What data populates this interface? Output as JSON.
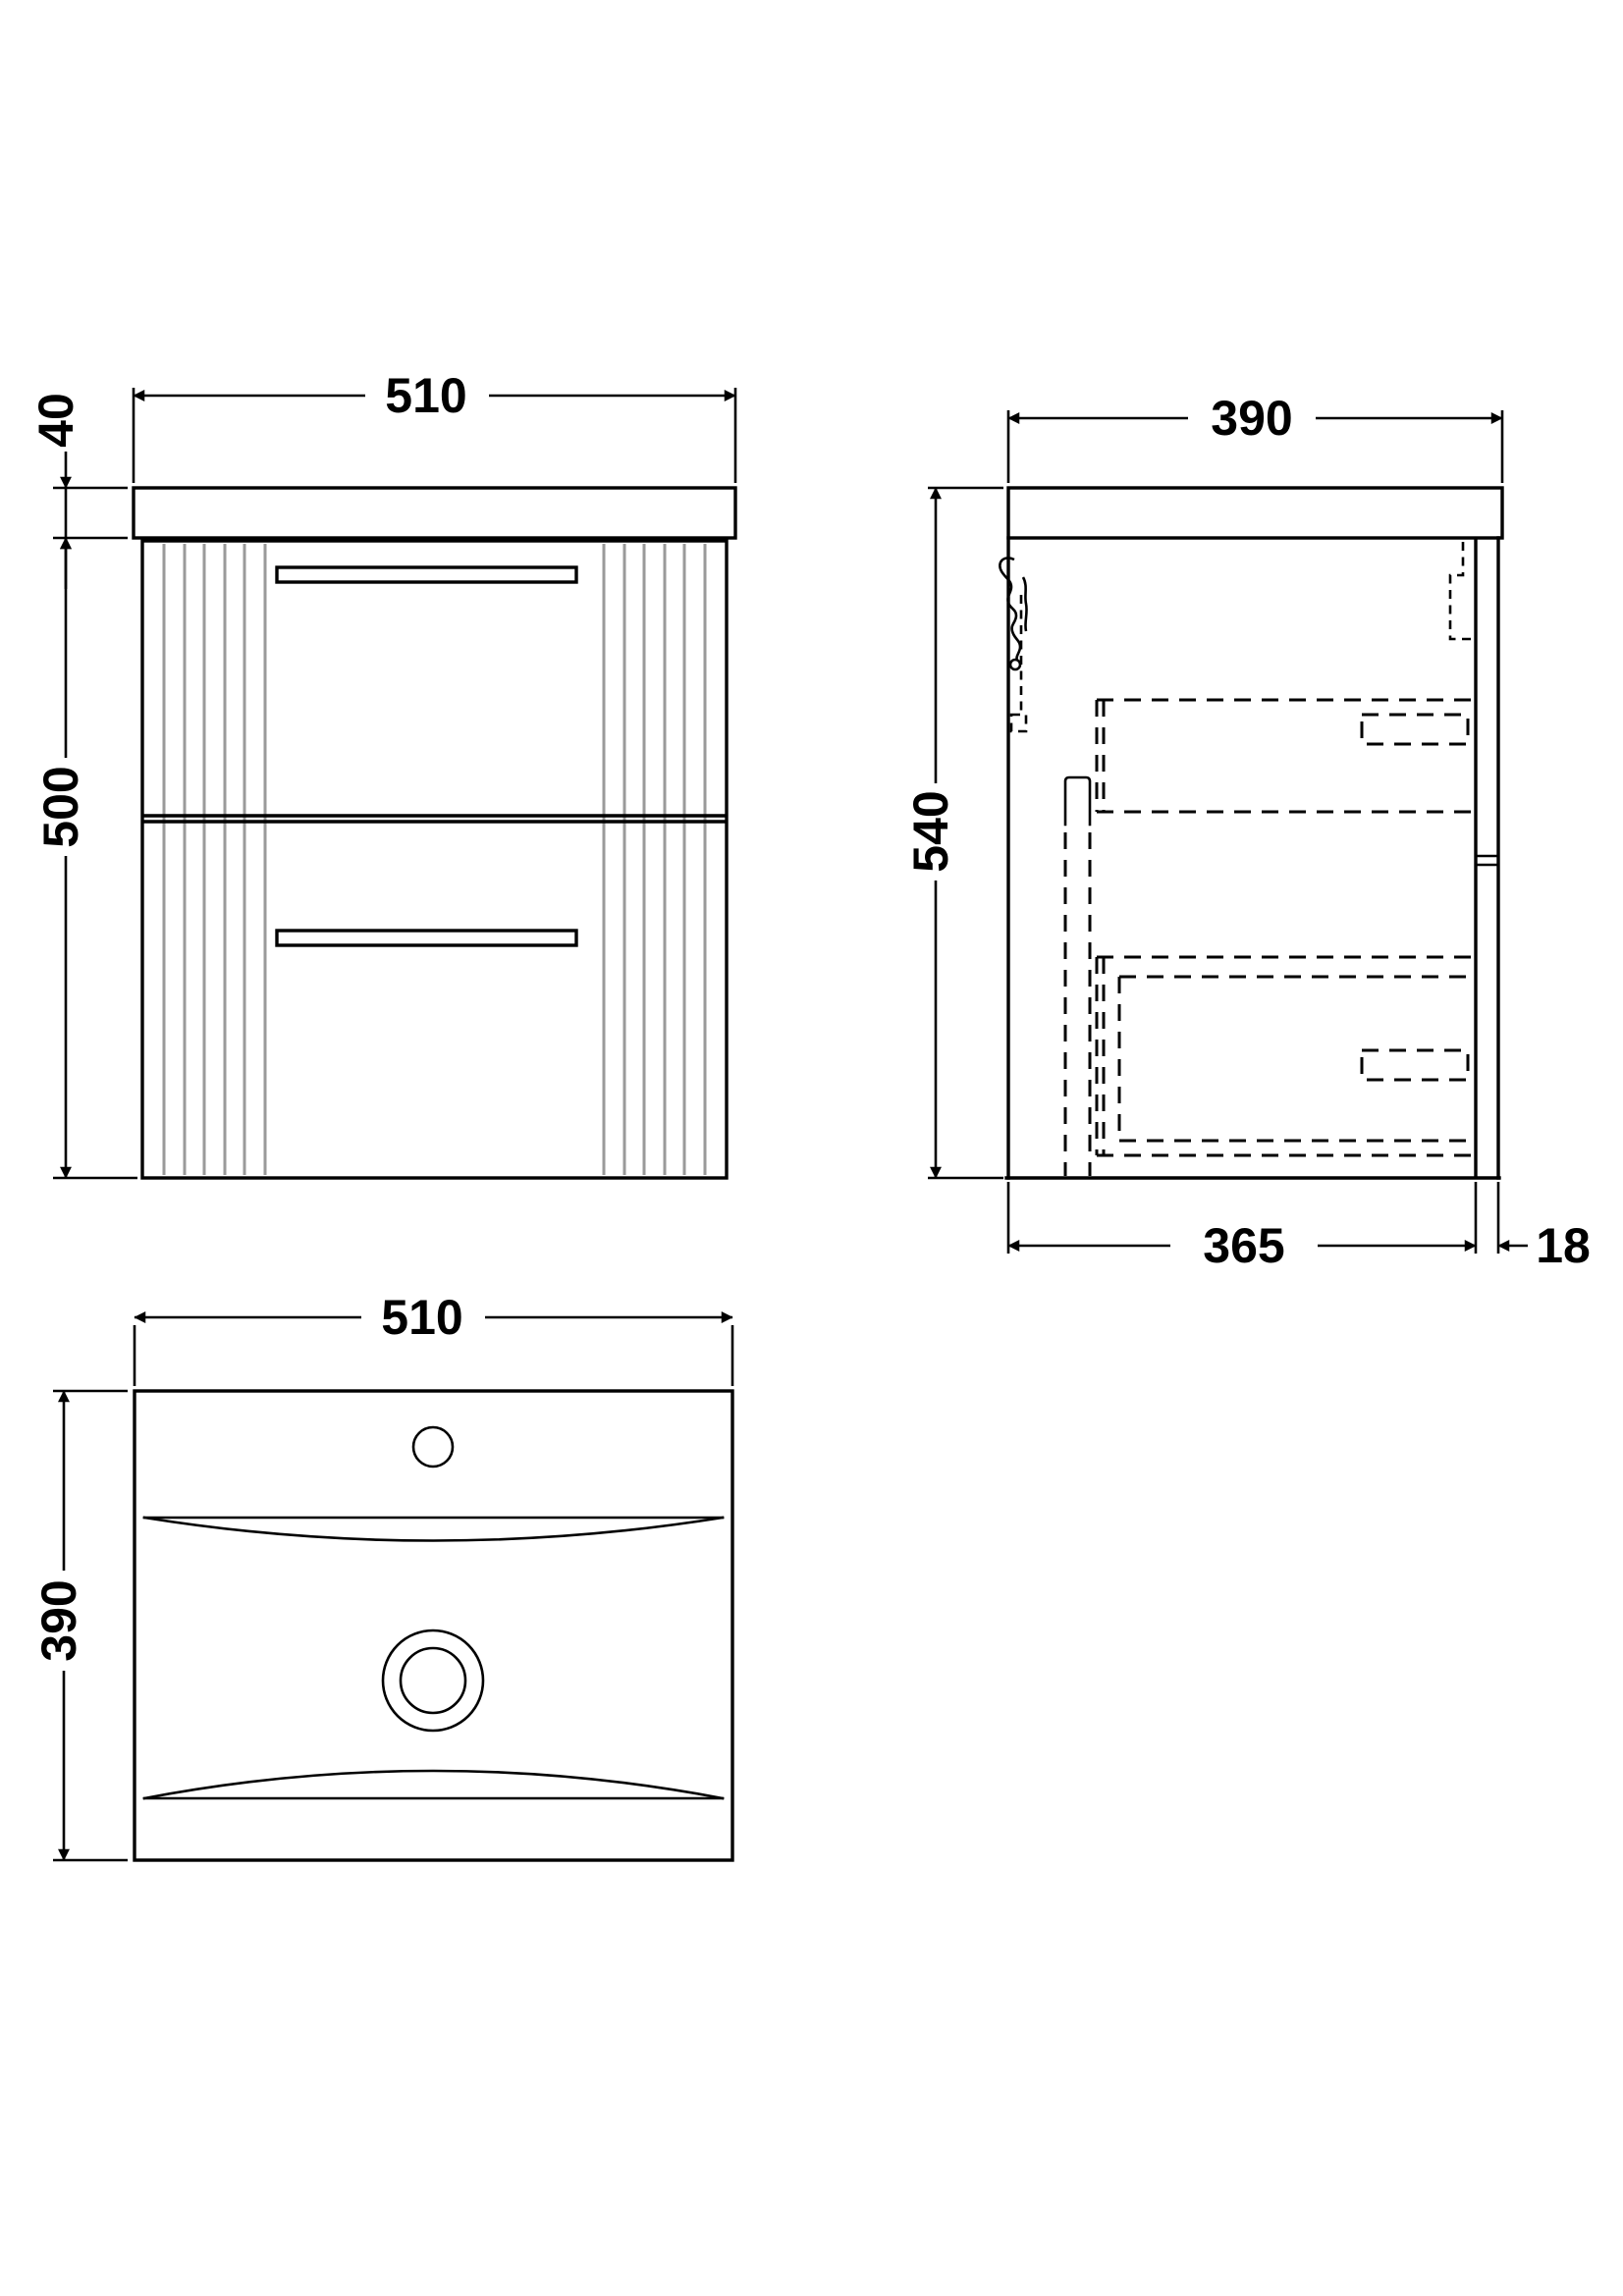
{
  "drawing": {
    "front_view": {
      "width": "510",
      "worktop_thickness": "40",
      "cabinet_height": "500"
    },
    "side_view": {
      "depth": "390",
      "overall_height": "540",
      "cabinet_depth": "365",
      "back_panel_thickness": "18"
    },
    "plan_view": {
      "width": "510",
      "depth": "390"
    }
  },
  "colors": {
    "line": "#000000",
    "flute": "#9a9a9a",
    "background": "#ffffff"
  }
}
